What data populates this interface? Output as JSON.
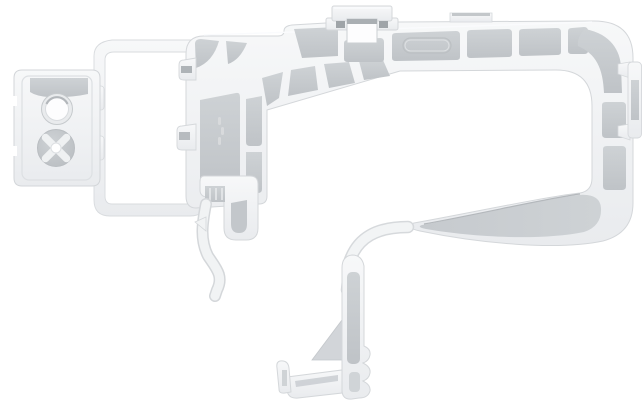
{
  "scene": {
    "description": "Product photo of a light gray molded plastic automotive mounting bracket on a white background",
    "background": "#ffffff"
  },
  "colors": {
    "body_light": "#f7f8f9",
    "body_dark": "#e9ebee",
    "edge": "#d4d7da",
    "panel_light": "#ced2d5",
    "panel_dark": "#bfc3c7",
    "wedge_light": "#c6cace",
    "wedge_dark": "#ced2d5",
    "recess_dark": "#9fa4a8",
    "gusset": "#d2d5d9",
    "highlight": "#fbfcfd",
    "hole_ring": "#e9ebed",
    "cross_recess": "#eff1f2"
  },
  "parts": {
    "left_fastener_plate": "fastener plate with round mounting hole and cross-recess boss",
    "mounting_hole": "round through mounting hole",
    "cross_boss": "circular boss with X-shaped recess",
    "open_loop_frame": "thin rectangular open loop frame",
    "main_frame": "ribbed C-shaped main frame with recessed panels",
    "rib_panels": "gray recessed rib panels",
    "top_clip_tab": "square snap tab on top edge",
    "top_flat_tab": "small flat tab on top edge",
    "embossed_outline": "embossed rounded-rectangle marking field",
    "right_side_clip": "snap clip on right outer edge",
    "support_wedge": "tapered support wedge inside lower arm",
    "lower_arm": "thin curved lower arm",
    "bottom_clip_leg": "bottom clip leg with scalloped edge",
    "foot_hook": "foot with upturned hook at bottom",
    "gusset": "triangular gusset at leg",
    "hook_finger": "curved hook finger hanging from column",
    "j_hook": "J-shaped hook under column",
    "edge_teeth": "small locating teeth on column edge",
    "molded_marking": "faint molded part marking"
  }
}
